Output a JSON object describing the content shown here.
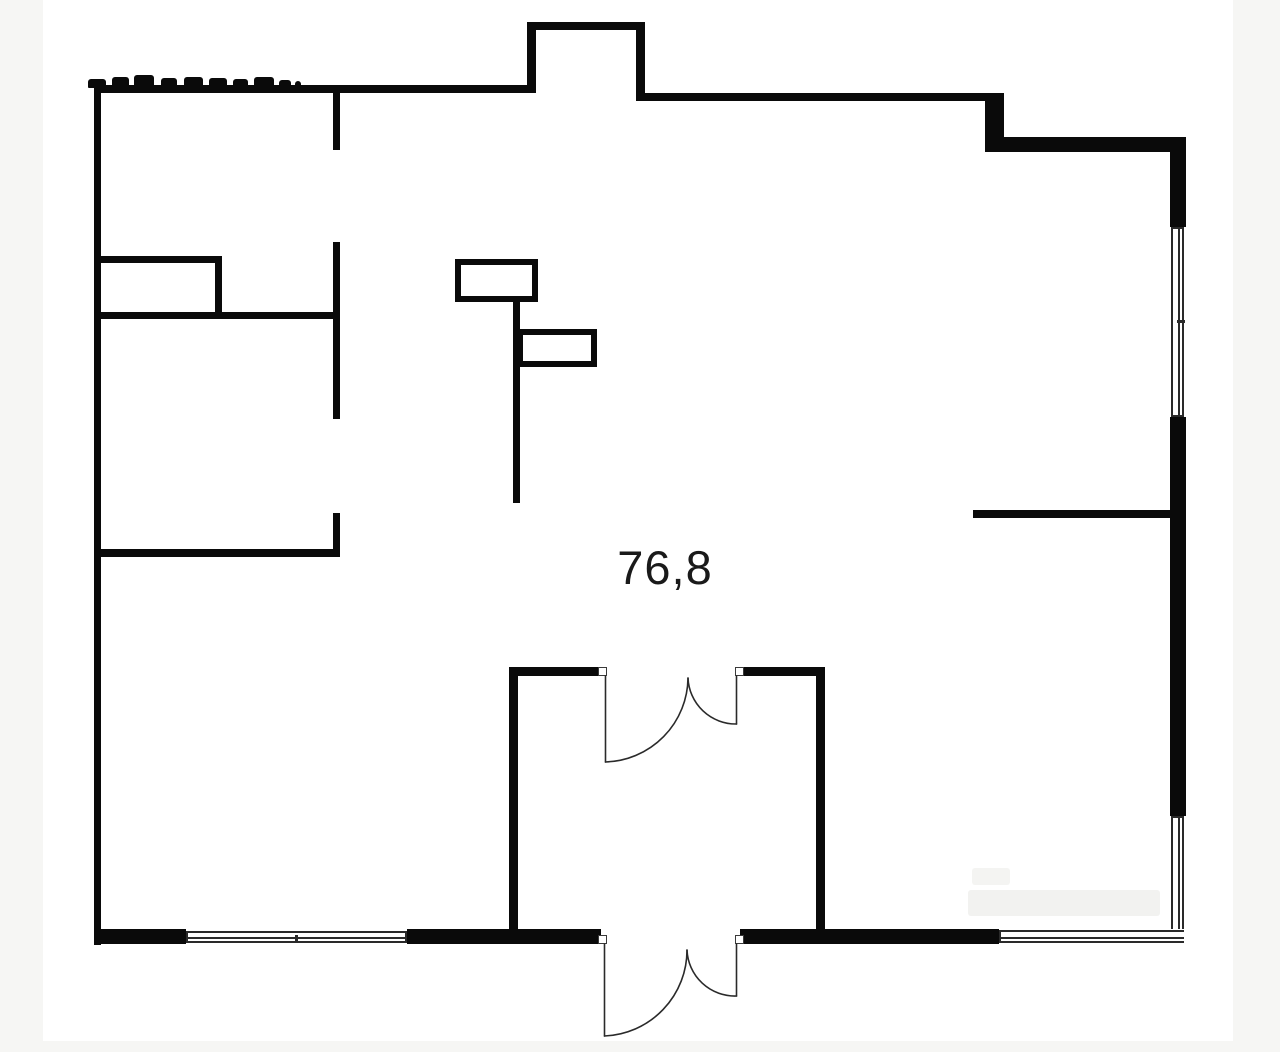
{
  "image": {
    "kind": "floor-plan"
  },
  "floor_plan": {
    "area_label": "76,8",
    "colors": {
      "wall": "#0a0a0a",
      "background": "#ffffff",
      "page_margin": "#f6f6f4",
      "line": "#2a2a2a"
    }
  }
}
